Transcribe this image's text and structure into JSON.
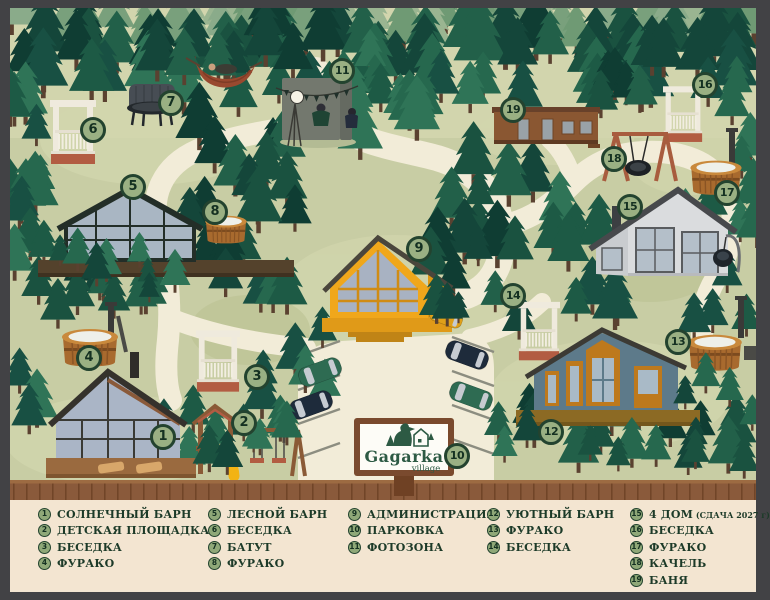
{
  "sign": {
    "brand": "Gagarka",
    "sub": "village"
  },
  "map": {
    "markers": [
      {
        "num": "1",
        "x": 163,
        "y": 437,
        "name": "sunny-barn"
      },
      {
        "num": "2",
        "x": 244,
        "y": 423,
        "name": "playground"
      },
      {
        "num": "3",
        "x": 257,
        "y": 377,
        "name": "gazebo-3"
      },
      {
        "num": "4",
        "x": 89,
        "y": 358,
        "name": "furako-4"
      },
      {
        "num": "5",
        "x": 133,
        "y": 187,
        "name": "forest-barn"
      },
      {
        "num": "6",
        "x": 93,
        "y": 130,
        "name": "gazebo-6"
      },
      {
        "num": "7",
        "x": 171,
        "y": 103,
        "name": "trampoline"
      },
      {
        "num": "8",
        "x": 215,
        "y": 212,
        "name": "furako-8"
      },
      {
        "num": "9",
        "x": 419,
        "y": 249,
        "name": "administration"
      },
      {
        "num": "10",
        "x": 457,
        "y": 456,
        "name": "parking"
      },
      {
        "num": "11",
        "x": 342,
        "y": 71,
        "name": "photo-zone"
      },
      {
        "num": "12",
        "x": 551,
        "y": 432,
        "name": "cozy-barn"
      },
      {
        "num": "13",
        "x": 678,
        "y": 342,
        "name": "furako-13"
      },
      {
        "num": "14",
        "x": 513,
        "y": 296,
        "name": "gazebo-14"
      },
      {
        "num": "15",
        "x": 630,
        "y": 207,
        "name": "house-4"
      },
      {
        "num": "16",
        "x": 705,
        "y": 85,
        "name": "gazebo-16"
      },
      {
        "num": "17",
        "x": 727,
        "y": 193,
        "name": "furako-17"
      },
      {
        "num": "18",
        "x": 614,
        "y": 159,
        "name": "swing"
      },
      {
        "num": "19",
        "x": 513,
        "y": 110,
        "name": "banya"
      }
    ]
  },
  "legend": {
    "columns": [
      {
        "items": [
          {
            "num": "1",
            "label": "СОЛНЕЧНЫЙ БАРН"
          },
          {
            "num": "2",
            "label": "ДЕТСКАЯ ПЛОЩАДКА"
          },
          {
            "num": "3",
            "label": "БЕСЕДКА"
          },
          {
            "num": "4",
            "label": "ФУРАКО"
          }
        ]
      },
      {
        "items": [
          {
            "num": "5",
            "label": "ЛЕСНОЙ БАРН"
          },
          {
            "num": "6",
            "label": "БЕСЕДКА"
          },
          {
            "num": "7",
            "label": "БАТУТ"
          },
          {
            "num": "8",
            "label": "ФУРАКО"
          }
        ]
      },
      {
        "items": [
          {
            "num": "9",
            "label": "АДМИНИСТРАЦИЯ"
          },
          {
            "num": "10",
            "label": "ПАРКОВКА"
          },
          {
            "num": "11",
            "label": "ФОТОЗОНА"
          }
        ]
      },
      {
        "items": [
          {
            "num": "12",
            "label": "УЮТНЫЙ БАРН"
          },
          {
            "num": "13",
            "label": "ФУРАКО"
          },
          {
            "num": "14",
            "label": "БЕСЕДКА"
          }
        ]
      },
      {
        "items": [
          {
            "num": "15",
            "label": "4 ДОМ",
            "note": "(СДАЧА 2027 г)"
          },
          {
            "num": "16",
            "label": "БЕСЕДКА"
          },
          {
            "num": "17",
            "label": "ФУРАКО"
          },
          {
            "num": "18",
            "label": "КАЧЕЛЬ"
          },
          {
            "num": "19",
            "label": "БАНЯ"
          }
        ]
      }
    ]
  },
  "colors": {
    "frame": "#424245",
    "map_bg": "#c8cda4",
    "path": "#f2ecd8",
    "legend_bg": "#f3e5d1",
    "fence": "#8a5a3b",
    "badge_fill": "#9ab083",
    "badge_ring": "#23432f",
    "legend_text": "#1c3a28",
    "logo_green": "#2d5a44",
    "barn_admin": "#f0a71b",
    "barn_cozy": "#5d7a8a",
    "tub_wood": "#a86a2e"
  }
}
